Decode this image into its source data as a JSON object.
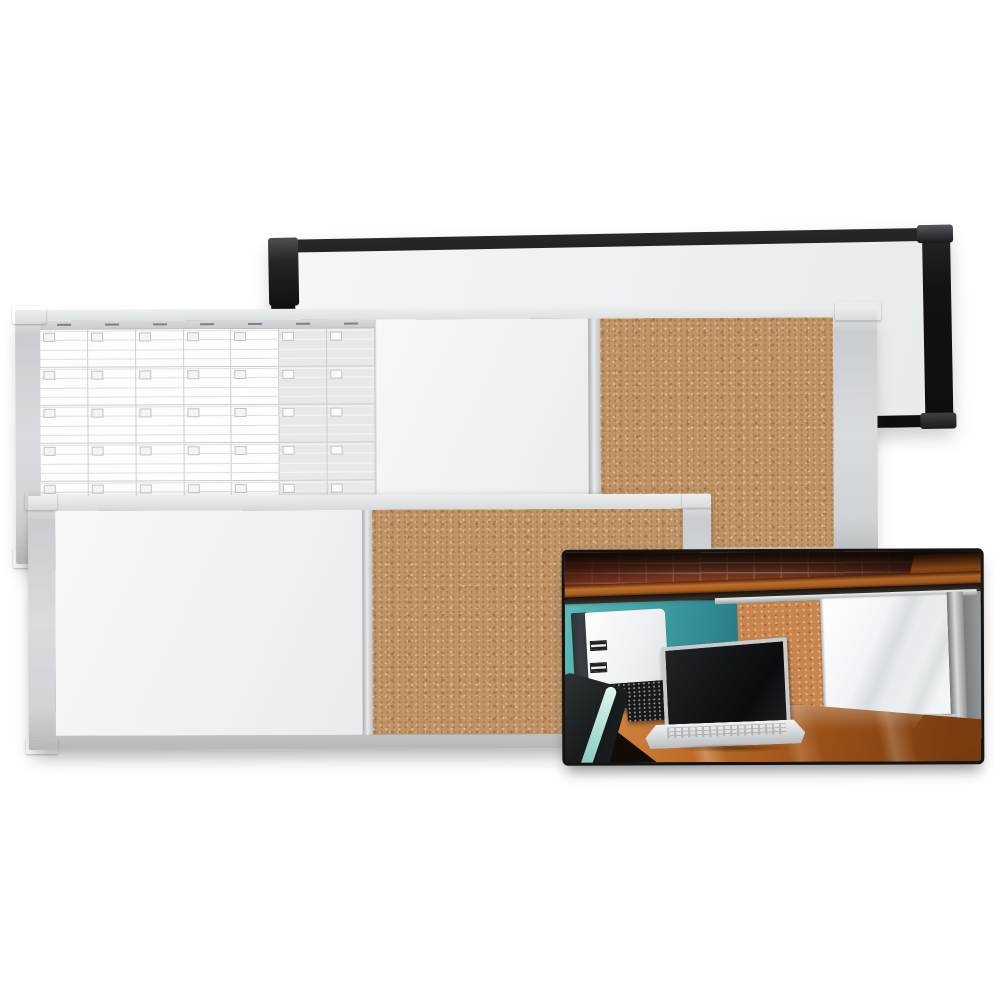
{
  "scene": {
    "kind": "product-photo",
    "subject": "wall-mounted combination dry-erase, planner and cork bulletin boards with office lifestyle inset photo",
    "boards": [
      {
        "id": "black-board",
        "frame": "black plastic",
        "sections": [
          {
            "type": "dry-erase"
          }
        ]
      },
      {
        "id": "planner-board",
        "frame": "silver aluminum",
        "sections": [
          {
            "type": "monthly-planner-grid"
          },
          {
            "type": "dry-erase"
          },
          {
            "type": "cork"
          }
        ]
      },
      {
        "id": "combo-board",
        "frame": "silver aluminum",
        "sections": [
          {
            "type": "dry-erase"
          },
          {
            "type": "cork"
          }
        ]
      }
    ],
    "inset_photo": {
      "contents": [
        "brick wall",
        "wood shelf",
        "teal cubicle panel",
        "white binder",
        "laptop",
        "keyboard trays",
        "mounted cork and dry-erase board",
        "wood desk",
        "chair edge"
      ]
    }
  },
  "calendar": {
    "columns": 7,
    "rows": 5,
    "weekend_columns": 2,
    "day_label_slots": 7,
    "lines_per_cell": 4,
    "has_date_boxes": true
  },
  "palette": {
    "bg": "#ffffff",
    "photo_border": "#141414",
    "black_frame": "#121214",
    "board_white": "#f0f1f2",
    "cal_line": "#dde0e2",
    "cork_base": "#c09467",
    "cork_light": "#d9b184",
    "cork_dark": "#a87c50",
    "silver": "#cfd3d5",
    "cap_gray": "#a9adaf",
    "brick": "#a74d2f",
    "teal": "#3f9fa3",
    "shelf": "#c06f2b",
    "desk": "#bc6c28",
    "laptop": "#c8cbcd",
    "screen": "#121316",
    "binder": "#fdfdfd",
    "mounted_cork": "#c8854e",
    "panel_gray": "#989c9e"
  }
}
